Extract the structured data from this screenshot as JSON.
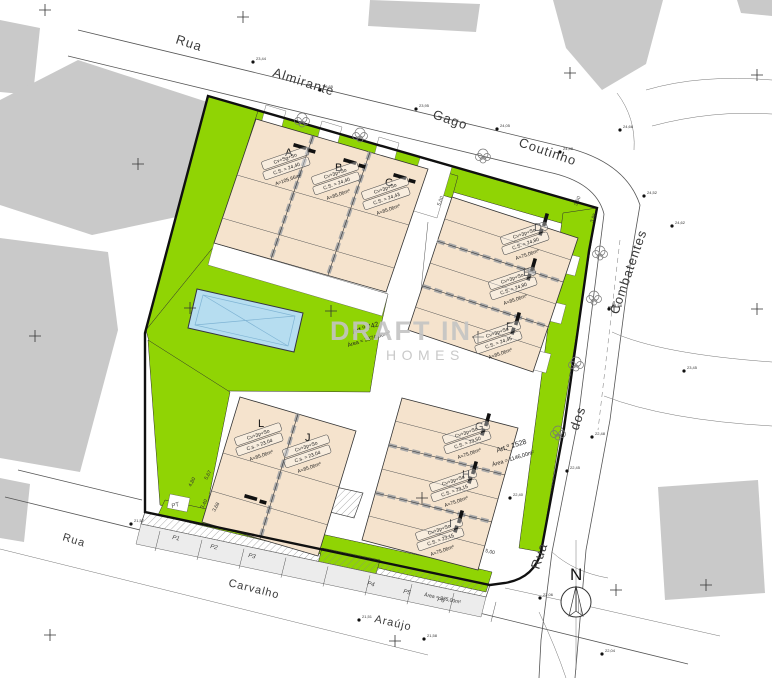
{
  "colors": {
    "green": "#90d404",
    "tan": "#f5e3cd",
    "pool": "#b6ddf0",
    "context": "#c9c9c9",
    "watermark": "#c4c4c4"
  },
  "streets": {
    "rua_top": "Rua",
    "almirante": "Almirante",
    "gago": "Gago",
    "coutinho": "Coutinho",
    "combatentes": "Combatentes",
    "dos": "dos",
    "rua_right": "Rua",
    "rua_bottom": "Rua",
    "carvalho": "Carvalho",
    "araujo": "Araújo"
  },
  "watermark": {
    "line1": "DRAFT IN",
    "line2": "HOMES"
  },
  "parcels": [
    {
      "art": "Art.º 742",
      "area": "Área = 2874,00m²"
    },
    {
      "art": "Art.º 1528",
      "area": "Área = 1146,00m²"
    }
  ],
  "north": {
    "label": "N"
  },
  "units": [
    {
      "id": "A",
      "type": "Cv+Sg+So",
      "cs": "C.S. = 24,40",
      "area": "A=105,66m²"
    },
    {
      "id": "B",
      "type": "Cv+3p+So",
      "cs": "C.S. = 24,40",
      "area": "A=85,06m²"
    },
    {
      "id": "C",
      "type": "Cv+3p+So",
      "cs": "C.S. = 24,43",
      "area": "A=85,06m²"
    },
    {
      "id": "D",
      "type": "Cv+3p+So",
      "cs": "C.S. = 24,80",
      "area": "A=75,06m²"
    },
    {
      "id": "E",
      "type": "Cv+3p+So",
      "cs": "C.S. = 24,80",
      "area": "A=85,06m²"
    },
    {
      "id": "F",
      "type": "Cv+3p+So",
      "cs": "C.S. = 24,45",
      "area": "A=85,06m²"
    },
    {
      "id": "G",
      "type": "Cv+3p+So",
      "cs": "C.S. = 23,50",
      "area": "A=75,06m²"
    },
    {
      "id": "H",
      "type": "Cv+3p+So",
      "cs": "C.S. = 23,15",
      "area": "A=75,06m²"
    },
    {
      "id": "I",
      "type": "Cv+3p+So",
      "cs": "C.S. = 23,15",
      "area": "A=75,06m²"
    },
    {
      "id": "L",
      "type": "Cv+3p+So",
      "cs": "C.s. = 23,04",
      "area": "A=85,06m²"
    },
    {
      "id": "J",
      "type": "Cv+3p+So",
      "cs": "C.s. = 23,04",
      "area": "A=85,06m²"
    }
  ],
  "parking": {
    "pt": "PT",
    "p1": "P1",
    "p2": "P2",
    "p3": "P3",
    "p4": "P4",
    "p5": "P5",
    "p6": "P6",
    "area": "Área = 335,00m²"
  },
  "dimensions": [
    "5,00",
    "3,50",
    "3,85",
    "5,67",
    "4,80",
    "3,40",
    "3,68",
    "5,00"
  ],
  "spot_elevations": [
    "23,44",
    "23,65",
    "23,95",
    "24,05",
    "24,48",
    "24,66",
    "24,52",
    "24,62",
    "24,58",
    "22,48",
    "22,45",
    "22,40",
    "22,06",
    "21,57",
    "21,51",
    "21,58",
    "22,04",
    "23,45"
  ]
}
